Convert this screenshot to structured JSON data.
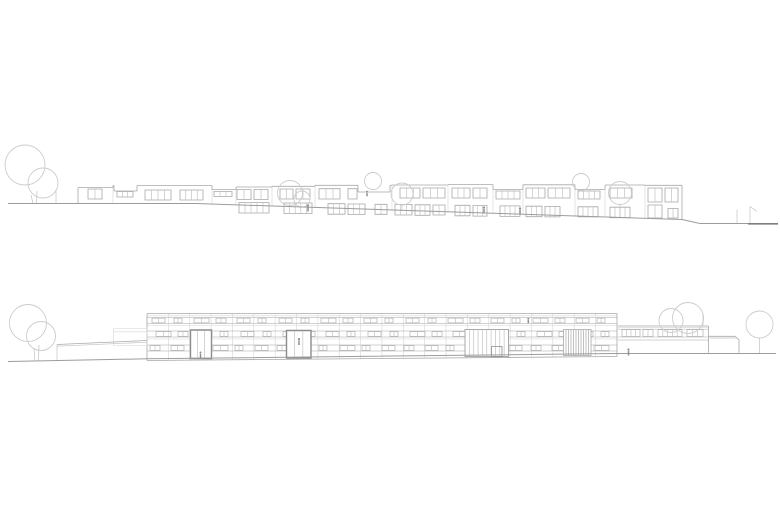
{
  "canvas": {
    "width": 780,
    "height": 520,
    "background": "#ffffff"
  },
  "palette": {
    "line": "#a8a8a8",
    "light": "#c2c2c2",
    "grid": "#d6d6d6",
    "dark": "#8c8c8c",
    "tree": "#cccccc",
    "ground": "#9c9c9c",
    "ground_dark": "#7d7d7d",
    "figure": "#8e8e8e",
    "band": "#b3b3b3",
    "white": "#ffffff"
  },
  "upper_elevation": {
    "description": "street elevation of stepped terraced housing on sloping ground",
    "ground": [
      [
        8,
        203.5
      ],
      [
        196,
        203.5
      ],
      [
        682,
        219.5
      ],
      [
        700,
        223.5
      ],
      [
        756,
        223.5
      ]
    ],
    "ground_dark": [
      748,
      223.8,
      778,
      223.8
    ],
    "edges": [
      [
        78,
        187.5,
        78,
        203.5
      ],
      [
        682,
        185.3,
        682,
        219.5
      ]
    ],
    "rooflines": [
      [
        78,
        113,
        187.5
      ],
      [
        113,
        114,
        185.5
      ],
      [
        137,
        212,
        185.5
      ],
      [
        212,
        236,
        189.5
      ],
      [
        236,
        272,
        187
      ],
      [
        272,
        315,
        186.3
      ],
      [
        315,
        358,
        185.3
      ],
      [
        390,
        392,
        185.3
      ],
      [
        392,
        448,
        185
      ],
      [
        448,
        493,
        184.6
      ],
      [
        493,
        523,
        189.5
      ],
      [
        523,
        575,
        184.8
      ],
      [
        575,
        605,
        189.5
      ],
      [
        605,
        645,
        185
      ],
      [
        645,
        682,
        185.3
      ]
    ],
    "steps": [
      [
        113,
        185.5,
        187.5
      ],
      [
        212,
        185.5,
        189.5
      ],
      [
        236,
        187,
        189.5
      ],
      [
        272,
        186.3,
        187
      ],
      [
        315,
        185.3,
        186.3
      ],
      [
        392,
        185,
        185.3
      ],
      [
        448,
        184.6,
        185
      ],
      [
        493,
        184.6,
        189.5
      ],
      [
        523,
        184.8,
        189.5
      ],
      [
        575,
        184.8,
        189.5
      ],
      [
        605,
        185,
        189.5
      ],
      [
        645,
        185,
        185.3
      ]
    ],
    "notches": [
      [
        114,
        137,
        185.5,
        191
      ],
      [
        358,
        390,
        185.3,
        192
      ]
    ],
    "upper_windows": [
      [
        88,
        14,
        189,
        10,
        1
      ],
      [
        117,
        16,
        191.5,
        5.5,
        2
      ],
      [
        145,
        26,
        190,
        10,
        3
      ],
      [
        180,
        23,
        190,
        10,
        3
      ],
      [
        214,
        18,
        191.5,
        5,
        2
      ],
      [
        237,
        14,
        189.5,
        10,
        1
      ],
      [
        254,
        14,
        189.5,
        10,
        1
      ],
      [
        280,
        13,
        189,
        10,
        1
      ],
      [
        296,
        14,
        189,
        10,
        1
      ],
      [
        319,
        21,
        188.7,
        10.3,
        2
      ],
      [
        348,
        9,
        188.7,
        10.3,
        0
      ],
      [
        400,
        20,
        188,
        10,
        2
      ],
      [
        423,
        22,
        188,
        10,
        2
      ],
      [
        452,
        18,
        188,
        10,
        2
      ],
      [
        473,
        14,
        188,
        10,
        1
      ],
      [
        496,
        24,
        191,
        8,
        3
      ],
      [
        526,
        19,
        188,
        10,
        2
      ],
      [
        548,
        22,
        188,
        10,
        2
      ],
      [
        578,
        22,
        191,
        8,
        3
      ],
      [
        610,
        22,
        188,
        10,
        2
      ],
      [
        648,
        14,
        188,
        14,
        1
      ],
      [
        665,
        13,
        188,
        14,
        1
      ]
    ],
    "lower_windows": [
      [
        239,
        30,
        202.5,
        10.5,
        4
      ],
      [
        284,
        28,
        203,
        10.5,
        4
      ],
      [
        328,
        17,
        203.7,
        10.5,
        2
      ],
      [
        348,
        17,
        204,
        10.5,
        2
      ],
      [
        375,
        12,
        204.3,
        10,
        1
      ],
      [
        395,
        17,
        204.5,
        10.5,
        2
      ],
      [
        415,
        15,
        204.8,
        10.5,
        2
      ],
      [
        433,
        12,
        205,
        10,
        1
      ],
      [
        455,
        15,
        205.3,
        10.5,
        2
      ],
      [
        473,
        14,
        205.6,
        10.5,
        2
      ],
      [
        500,
        20,
        205.9,
        10.5,
        3
      ],
      [
        526,
        16,
        206.2,
        10.5,
        2
      ],
      [
        545,
        15,
        206.4,
        10.5,
        2
      ],
      [
        578,
        20,
        206.8,
        10,
        3
      ],
      [
        610,
        20,
        207.2,
        10.5,
        3
      ],
      [
        648,
        14,
        205,
        13,
        1
      ],
      [
        668,
        10,
        208.5,
        9.5,
        1
      ]
    ],
    "trees": [
      {
        "circles": [
          [
            25,
            165,
            20
          ],
          [
            43,
            183,
            15
          ]
        ],
        "trunks": [
          [
            31,
            195,
            33,
            203.5
          ],
          [
            37,
            191,
            36.5,
            203.5
          ]
        ]
      },
      {
        "circles": [
          [
            290,
            193,
            12.5
          ],
          [
            302,
            199,
            8
          ]
        ],
        "trunks": [
          [
            294,
            205.5,
            294,
            207.5
          ]
        ]
      },
      {
        "circles": [
          [
            373,
            181,
            8.5
          ]
        ],
        "trunks": []
      },
      {
        "circles": [
          [
            402,
            194,
            11
          ]
        ],
        "trunks": [
          [
            402,
            205,
            402,
            211.2
          ]
        ]
      },
      {
        "circles": [
          [
            581,
            182,
            8.5
          ]
        ],
        "trunks": []
      },
      {
        "circles": [
          [
            620,
            193,
            11.5
          ]
        ],
        "trunks": [
          [
            620,
            204.5,
            620,
            217.5
          ]
        ]
      }
    ],
    "pole": [
      56,
      190,
      56,
      203.5
    ],
    "hut_lines": [
      [
        737,
        209.5,
        737,
        223
      ],
      [
        750,
        206.5,
        750,
        223
      ],
      [
        750,
        206.5,
        757,
        211.5
      ]
    ],
    "figures": [
      [
        308,
        211.5,
        7
      ],
      [
        367,
        196.3,
        5.5
      ],
      [
        484,
        213.5,
        7
      ],
      [
        520,
        214.5,
        7
      ]
    ]
  },
  "lower_elevation": {
    "description": "long three-storey slab building with ribbon windows, entrances, louvre screen and low side wing",
    "ground": [
      [
        8,
        361.5
      ],
      [
        147,
        358.8
      ],
      [
        615,
        353.5
      ],
      [
        776,
        353.5
      ]
    ],
    "building": {
      "x1": 147,
      "x2": 617,
      "top": 313.5,
      "base_left": 360.5,
      "base_right": 356.5
    },
    "horizontals": [
      [
        315.8,
        "light"
      ],
      [
        317.5,
        "line"
      ],
      [
        323.5,
        "line"
      ],
      [
        325.5,
        "light"
      ],
      [
        331,
        "line"
      ],
      [
        337,
        "line"
      ],
      [
        339,
        "light"
      ],
      [
        345,
        "line"
      ],
      [
        351,
        "line"
      ]
    ],
    "bay_step": 21.36,
    "bands": [
      {
        "y": 317.5,
        "h": 6,
        "groups": [
          [
            152,
            13
          ],
          [
            174,
            8
          ],
          [
            194,
            15
          ],
          [
            216,
            10
          ],
          [
            237,
            13
          ],
          [
            258,
            8
          ],
          [
            279,
            13
          ],
          [
            301,
            8
          ],
          [
            321,
            15
          ],
          [
            343,
            10
          ],
          [
            364,
            13
          ],
          [
            385,
            8
          ],
          [
            406,
            13
          ],
          [
            428,
            8
          ],
          [
            448,
            15
          ],
          [
            470,
            10
          ],
          [
            491,
            13
          ],
          [
            512,
            8
          ],
          [
            533,
            15
          ],
          [
            555,
            10
          ],
          [
            576,
            13
          ],
          [
            597,
            8
          ]
        ]
      },
      {
        "y": 331,
        "h": 6,
        "groups": [
          [
            156,
            15
          ],
          [
            178,
            10
          ],
          [
            199,
            13
          ],
          [
            220,
            8
          ],
          [
            241,
            13
          ],
          [
            263,
            8
          ],
          [
            283,
            15
          ],
          [
            305,
            10
          ],
          [
            326,
            13
          ],
          [
            347,
            8
          ],
          [
            368,
            13
          ],
          [
            390,
            8
          ],
          [
            410,
            15
          ],
          [
            432,
            10
          ],
          [
            453,
            13
          ],
          [
            474,
            8
          ],
          [
            495,
            13
          ],
          [
            517,
            8
          ],
          [
            537,
            15
          ],
          [
            559,
            10
          ],
          [
            580,
            13
          ],
          [
            601,
            8
          ]
        ]
      },
      {
        "y": 345,
        "h": 6,
        "groups": [
          [
            150,
            10
          ],
          [
            171,
            13
          ],
          [
            192,
            8
          ],
          [
            213,
            15
          ],
          [
            235,
            8
          ],
          [
            255,
            13
          ],
          [
            277,
            10
          ],
          [
            298,
            13
          ],
          [
            319,
            8
          ],
          [
            340,
            15
          ],
          [
            362,
            8
          ],
          [
            382,
            13
          ],
          [
            404,
            10
          ],
          [
            425,
            13
          ],
          [
            446,
            8
          ],
          [
            467,
            15
          ],
          [
            489,
            8
          ],
          [
            509,
            13
          ],
          [
            531,
            10
          ],
          [
            552,
            13
          ],
          [
            573,
            8
          ],
          [
            594,
            15
          ]
        ]
      }
    ],
    "openings": [
      {
        "type": "door",
        "x": 190.5,
        "y": 330,
        "w": 21,
        "h": 28.5,
        "mullions": 2
      },
      {
        "type": "door",
        "x": 286.5,
        "y": 330.5,
        "w": 24.5,
        "h": 27.5,
        "mullions": 2
      },
      {
        "type": "entrance",
        "x": 465,
        "y": 329.5,
        "w": 43.5,
        "h": 27,
        "mullions": 9,
        "door": [
          491.5,
          346.5,
          10.5,
          10
        ]
      },
      {
        "type": "louvre",
        "x": 563.5,
        "y": 329.5,
        "w": 27.5,
        "h": 26,
        "slats": 10
      }
    ],
    "annex": {
      "rect": [
        113.5,
        328.5,
        33.5,
        17
      ],
      "coping": 331.8
    },
    "ramp": {
      "top": [
        57,
        344.5,
        147,
        340.5
      ],
      "echo": [
        57,
        346.2,
        147,
        342.2
      ],
      "post": [
        57,
        344.5,
        57,
        361.2
      ]
    },
    "wing": {
      "x1": 618,
      "x2": 708.5,
      "top": 326,
      "coping": 327.6,
      "bottom": 340,
      "band_top": 329.2,
      "band_bot": 337,
      "right_base": 352.8,
      "windows": [
        [
          622,
          18,
          3
        ],
        [
          643,
          10,
          1
        ],
        [
          658,
          24,
          4
        ],
        [
          687,
          16,
          2
        ]
      ]
    },
    "low_wall": {
      "top": [
        708.5,
        336.3,
        735,
        336.3
      ],
      "bevel": [
        735,
        336.3,
        739,
        339.8
      ],
      "echo": [
        709.5,
        338,
        735.5,
        338
      ],
      "right": [
        739,
        339.8,
        739,
        352.8
      ]
    },
    "trees": [
      {
        "circles": [
          [
            28,
            323,
            18.5
          ],
          [
            41,
            336,
            14.5
          ]
        ],
        "trunks": [
          [
            34,
            349,
            35,
            361.2
          ],
          [
            39,
            345,
            38.5,
            360.9
          ]
        ]
      },
      {
        "circles": [
          [
            671,
            320.5,
            12
          ],
          [
            688,
            318,
            15.5
          ]
        ],
        "trunks": [
          [
            703,
            315,
            703,
            326
          ]
        ]
      },
      {
        "circles": [
          [
            759.5,
            324.5,
            13.5
          ]
        ],
        "trunks": [
          [
            759.5,
            338,
            759.5,
            353
          ]
        ]
      }
    ],
    "figures": [
      [
        200.5,
        358,
        6.5
      ],
      [
        299,
        345,
        7
      ],
      [
        528.3,
        323.3,
        5.5
      ],
      [
        628.5,
        355.5,
        7
      ]
    ]
  }
}
